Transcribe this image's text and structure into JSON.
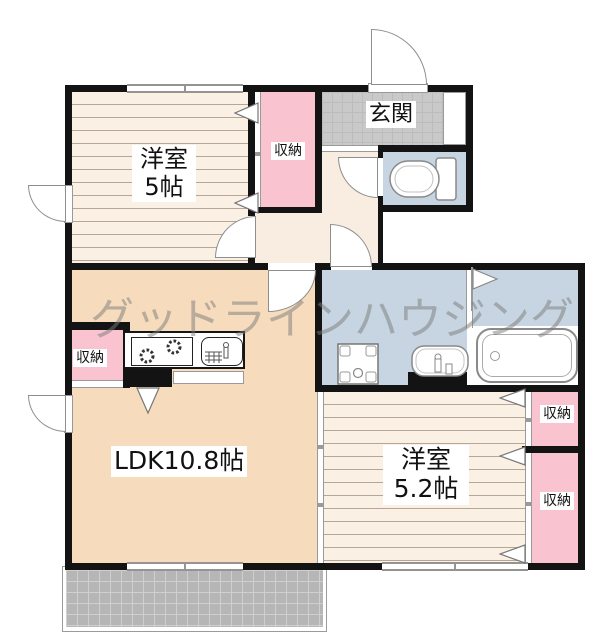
{
  "watermark": "グッドラインハウジング",
  "rooms": {
    "yoshitsu5": {
      "name": "洋室",
      "size": "5帖"
    },
    "genkan": "玄関",
    "closet_top": "収納",
    "closet_ldk": "収納",
    "ldk": "LDK10.8帖",
    "yoshitsu52": {
      "name": "洋室",
      "size": "5.2帖"
    },
    "closet_right_top": "収納",
    "closet_right_bottom": "収納"
  },
  "colors": {
    "wall": "#131313",
    "floor-a": "#fbf0e4",
    "floor-line": "#b5a698",
    "ldk": "#f6dcbc",
    "hall": "#f9ece1",
    "pink": "#f9c4d0",
    "blue": "#c6d5e1",
    "tile": "#c9c9c9",
    "tile-line": "#bcbcbc",
    "balcony": "#b6b6b6",
    "balcony-line": "#cfcfcf"
  }
}
